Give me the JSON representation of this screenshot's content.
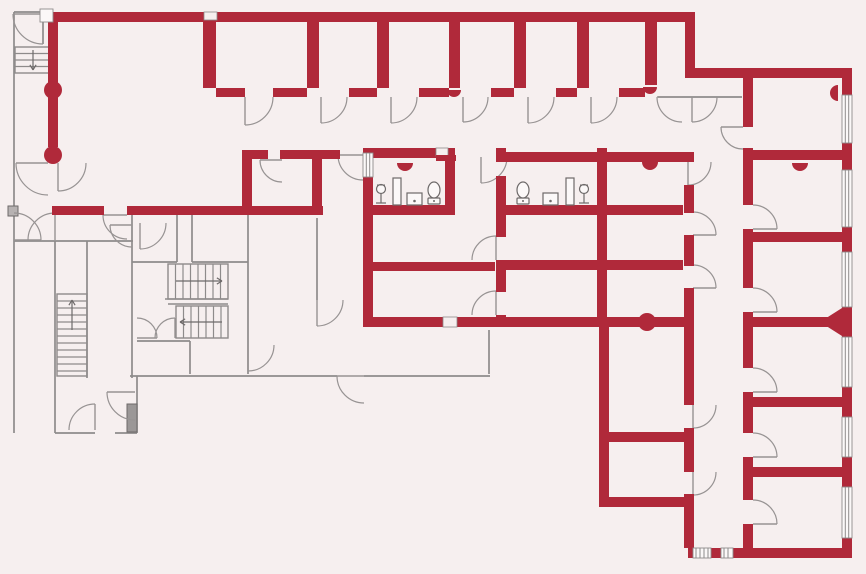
{
  "meta": {
    "kind": "architectural-floor-plan",
    "canvas_width": 866,
    "canvas_height": 574
  },
  "palette": {
    "background": "#f6efef",
    "wall_primary": "#b0293a",
    "wall_thin": "#8e8b8b",
    "door_arc": "#979393",
    "fixture": "#6e6a6a",
    "window_fill": "#fbf8f8",
    "window_line": "#8e8b8b",
    "threshold_fill": "#b7b2b2",
    "elevator_fill": "#9b9797"
  },
  "plan": {
    "red_walls": [
      [
        48,
        12,
        647,
        10
      ],
      [
        685,
        12,
        10,
        66
      ],
      [
        695,
        68,
        157,
        10
      ],
      [
        842,
        68,
        10,
        490
      ],
      [
        688,
        548,
        164,
        10
      ],
      [
        48,
        22,
        10,
        62
      ],
      [
        48,
        97,
        10,
        50
      ],
      [
        52,
        206,
        52,
        9
      ],
      [
        127,
        206,
        196,
        9
      ],
      [
        242,
        150,
        26,
        9
      ],
      [
        280,
        150,
        60,
        9
      ],
      [
        312,
        150,
        10,
        65
      ],
      [
        242,
        157,
        10,
        52
      ],
      [
        363,
        148,
        10,
        179
      ],
      [
        363,
        148,
        92,
        10
      ],
      [
        445,
        148,
        10,
        65
      ],
      [
        363,
        205,
        92,
        10
      ],
      [
        363,
        262,
        132,
        9
      ],
      [
        496,
        148,
        10,
        14
      ],
      [
        496,
        176,
        10,
        61
      ],
      [
        496,
        260,
        10,
        32
      ],
      [
        496,
        315,
        10,
        12
      ],
      [
        506,
        152,
        188,
        10
      ],
      [
        506,
        205,
        95,
        10
      ],
      [
        506,
        260,
        91,
        10
      ],
      [
        597,
        148,
        10,
        179
      ],
      [
        607,
        205,
        76,
        10
      ],
      [
        607,
        260,
        76,
        10
      ],
      [
        363,
        317,
        330,
        10
      ],
      [
        684,
        185,
        10,
        28
      ],
      [
        684,
        235,
        10,
        31
      ],
      [
        684,
        288,
        10,
        117
      ],
      [
        684,
        428,
        10,
        44
      ],
      [
        684,
        494,
        10,
        54
      ],
      [
        743,
        78,
        10,
        49
      ],
      [
        743,
        148,
        10,
        57
      ],
      [
        743,
        229,
        10,
        59
      ],
      [
        743,
        312,
        10,
        56
      ],
      [
        743,
        392,
        10,
        41
      ],
      [
        743,
        457,
        10,
        43
      ],
      [
        743,
        524,
        10,
        24
      ],
      [
        743,
        150,
        99,
        10
      ],
      [
        743,
        232,
        99,
        10
      ],
      [
        743,
        317,
        99,
        10
      ],
      [
        743,
        397,
        99,
        10
      ],
      [
        743,
        467,
        99,
        10
      ],
      [
        599,
        325,
        10,
        182
      ],
      [
        599,
        432,
        94,
        10
      ],
      [
        599,
        497,
        94,
        10
      ],
      [
        203,
        22,
        13,
        66
      ],
      [
        307,
        22,
        12,
        66
      ],
      [
        377,
        22,
        12,
        66
      ],
      [
        449,
        22,
        11,
        66
      ],
      [
        514,
        22,
        12,
        66
      ],
      [
        577,
        22,
        12,
        66
      ],
      [
        645,
        22,
        12,
        63
      ],
      [
        216,
        88,
        29,
        9
      ],
      [
        273,
        88,
        34,
        9
      ],
      [
        349,
        88,
        28,
        9
      ],
      [
        419,
        88,
        30,
        9
      ],
      [
        491,
        88,
        23,
        9
      ],
      [
        556,
        88,
        21,
        9
      ],
      [
        619,
        88,
        26,
        9
      ]
    ],
    "white_notches": [
      [
        204,
        12,
        13,
        8
      ],
      [
        436,
        148,
        12,
        8
      ],
      [
        443,
        317,
        14,
        10
      ]
    ],
    "red_patches": [
      [
        436,
        155,
        20,
        6
      ]
    ],
    "columns": [
      [
        53,
        90,
        9
      ],
      [
        53,
        155,
        9
      ],
      [
        647,
        322,
        9
      ]
    ],
    "hinge_bumps": [
      [
        405,
        163,
        8,
        "S"
      ],
      [
        650,
        162,
        8,
        "S"
      ],
      [
        454,
        90,
        7,
        "S"
      ],
      [
        650,
        87,
        7,
        "S"
      ],
      [
        838,
        93,
        8,
        "W"
      ],
      [
        800,
        163,
        8,
        "S"
      ]
    ],
    "flares": [
      [
        [
          842,
          308
        ],
        [
          842,
          336
        ],
        [
          820,
          322
        ]
      ]
    ],
    "thin_walls": [
      [
        14,
        12,
        14,
        433
      ],
      [
        14,
        12,
        40,
        12
      ],
      [
        14,
        241,
        133,
        241
      ],
      [
        55,
        241,
        55,
        433
      ],
      [
        87,
        241,
        87,
        378
      ],
      [
        132,
        215,
        132,
        378
      ],
      [
        132,
        262,
        177,
        262
      ],
      [
        192,
        262,
        248,
        262
      ],
      [
        177,
        215,
        177,
        262
      ],
      [
        192,
        215,
        192,
        262
      ],
      [
        248,
        215,
        248,
        374
      ],
      [
        137,
        341,
        190,
        341
      ],
      [
        190,
        341,
        190,
        374
      ],
      [
        130,
        376,
        337,
        376
      ],
      [
        364,
        376,
        490,
        376
      ],
      [
        489,
        330,
        489,
        374
      ],
      [
        317,
        218,
        317,
        300
      ],
      [
        55,
        433,
        95,
        433
      ],
      [
        115,
        433,
        137,
        433
      ],
      [
        137,
        376,
        137,
        433
      ],
      [
        658,
        97,
        742,
        97
      ],
      [
        43,
        14,
        43,
        44
      ]
    ],
    "doors": [
      [
        245,
        97,
        28,
        0,
        90
      ],
      [
        321,
        97,
        26,
        0,
        90
      ],
      [
        391,
        97,
        26,
        0,
        90
      ],
      [
        463,
        97,
        25,
        0,
        90
      ],
      [
        528,
        97,
        26,
        0,
        90
      ],
      [
        591,
        97,
        26,
        0,
        90
      ],
      [
        682,
        97,
        25,
        90,
        180
      ],
      [
        692,
        97,
        25,
        0,
        90
      ],
      [
        363,
        155,
        25,
        90,
        180
      ],
      [
        481,
        157,
        26,
        0,
        90
      ],
      [
        282,
        160,
        22,
        90,
        180
      ],
      [
        127,
        215,
        24,
        90,
        180
      ],
      [
        496,
        260,
        24,
        180,
        270
      ],
      [
        496,
        315,
        24,
        180,
        270
      ],
      [
        688,
        162,
        23,
        0,
        90
      ],
      [
        693,
        235,
        23,
        270,
        0
      ],
      [
        693,
        288,
        23,
        270,
        0
      ],
      [
        693,
        405,
        23,
        0,
        90
      ],
      [
        693,
        472,
        23,
        0,
        90
      ],
      [
        743,
        127,
        22,
        90,
        180
      ],
      [
        753,
        229,
        24,
        270,
        0
      ],
      [
        753,
        312,
        24,
        270,
        0
      ],
      [
        753,
        392,
        24,
        270,
        0
      ],
      [
        753,
        457,
        24,
        270,
        0
      ],
      [
        753,
        524,
        24,
        270,
        0
      ],
      [
        317,
        300,
        26,
        0,
        90
      ],
      [
        248,
        345,
        26,
        0,
        90
      ],
      [
        132,
        225,
        22,
        90,
        180
      ],
      [
        48,
        163,
        32,
        90,
        180
      ],
      [
        58,
        163,
        28,
        0,
        90
      ],
      [
        14,
        240,
        27,
        270,
        0
      ],
      [
        55,
        240,
        27,
        180,
        270
      ],
      [
        95,
        430,
        26,
        180,
        270
      ],
      [
        135,
        392,
        28,
        90,
        180
      ],
      [
        364,
        376,
        27,
        90,
        180
      ],
      [
        137,
        338,
        20,
        270,
        0
      ],
      [
        175,
        338,
        20,
        180,
        270
      ],
      [
        140,
        223,
        26,
        0,
        90
      ],
      [
        43,
        14,
        30,
        90,
        180
      ]
    ],
    "windows": [
      {
        "rect": [
          842,
          95,
          10,
          48
        ],
        "orient": "v",
        "style": "double"
      },
      {
        "rect": [
          842,
          170,
          10,
          57
        ],
        "orient": "v",
        "style": "double"
      },
      {
        "rect": [
          842,
          252,
          10,
          55
        ],
        "orient": "v",
        "style": "double"
      },
      {
        "rect": [
          842,
          337,
          10,
          50
        ],
        "orient": "v",
        "style": "double"
      },
      {
        "rect": [
          842,
          417,
          10,
          40
        ],
        "orient": "v",
        "style": "double"
      },
      {
        "rect": [
          842,
          487,
          10,
          51
        ],
        "orient": "v",
        "style": "double"
      },
      {
        "rect": [
          693,
          548,
          18,
          10
        ],
        "orient": "h",
        "style": "hatch"
      },
      {
        "rect": [
          721,
          548,
          12,
          10
        ],
        "orient": "h",
        "style": "hatch"
      },
      {
        "rect": [
          363,
          153,
          10,
          24
        ],
        "orient": "v",
        "style": "double"
      },
      {
        "rect": [
          40,
          9,
          13,
          13
        ],
        "orient": "h",
        "style": "plain"
      }
    ],
    "stairs": [
      {
        "box": [
          15,
          47,
          37,
          26
        ],
        "treads": "h",
        "step": 6.5,
        "arrow": {
          "x1": 33,
          "y1": 50,
          "x2": 33,
          "y2": 70
        }
      },
      {
        "box": [
          57,
          294,
          30,
          82
        ],
        "treads": "h",
        "step": 7,
        "arrow": {
          "x1": 72,
          "y1": 330,
          "x2": 72,
          "y2": 300
        }
      },
      {
        "box": [
          168,
          264,
          60,
          35
        ],
        "treads": "v",
        "step": 7.5,
        "arrow": {
          "x1": 176,
          "y1": 281,
          "x2": 222,
          "y2": 281
        }
      },
      {
        "box": [
          176,
          306,
          52,
          32
        ],
        "treads": "v",
        "step": 7.5,
        "arrow": {
          "x1": 222,
          "y1": 322,
          "x2": 180,
          "y2": 322
        }
      }
    ],
    "landing_lines": [
      [
        165,
        299,
        228,
        299
      ],
      [
        168,
        304,
        228,
        304
      ]
    ],
    "fixtures": [
      {
        "type": "pedestal",
        "x": 375,
        "y": 205
      },
      {
        "type": "cabinet",
        "x": 393,
        "y": 205
      },
      {
        "type": "sink",
        "x": 407,
        "y": 205
      },
      {
        "type": "toilet",
        "x": 427,
        "y": 205
      },
      {
        "type": "toilet",
        "x": 516,
        "y": 205
      },
      {
        "type": "sink",
        "x": 543,
        "y": 205
      },
      {
        "type": "cabinet",
        "x": 566,
        "y": 205
      },
      {
        "type": "pedestal",
        "x": 578,
        "y": 205
      }
    ],
    "misc_rects": [
      {
        "rect": [
          8,
          206,
          10,
          10
        ],
        "fill": "threshold_fill",
        "name": "door-threshold"
      },
      {
        "rect": [
          127,
          404,
          10,
          28
        ],
        "fill": "elevator_fill",
        "name": "elevator-shaft"
      }
    ]
  }
}
